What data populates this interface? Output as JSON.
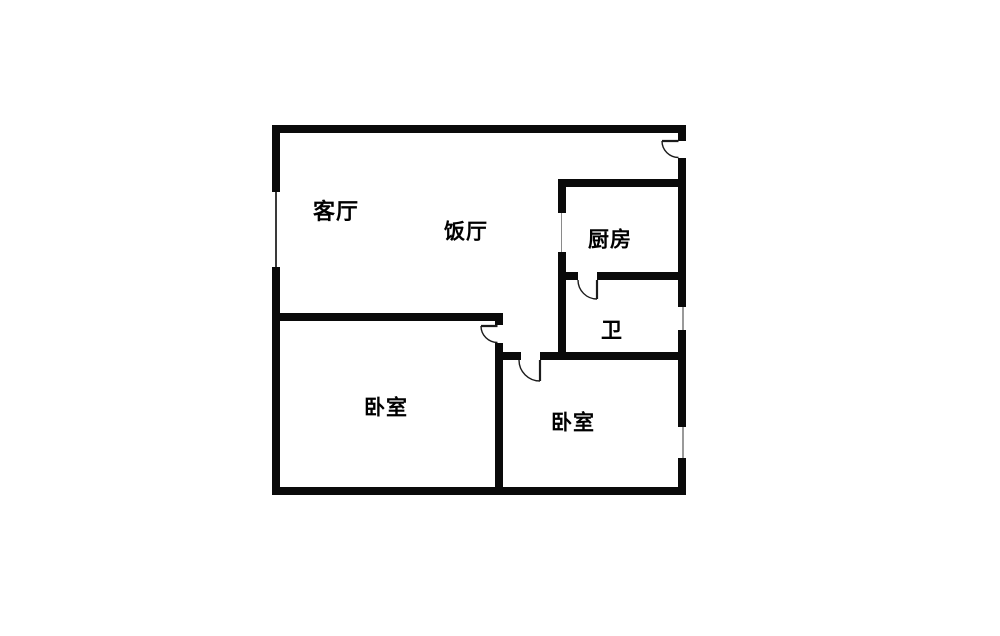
{
  "title": "two-bedroom-apartment-floor-plan",
  "colors": {
    "background": "#ffffff",
    "wall": "#0a0a0a",
    "door_line": "#1c1c1c",
    "window_line_dark": "#3a3a3a",
    "window_line_light": "#9a9a9a",
    "opening_line": "#8a8a8a",
    "label": "#000000"
  },
  "rooms": {
    "living_room": {
      "label": "客厅"
    },
    "dining_room": {
      "label": "饭厅"
    },
    "kitchen": {
      "label": "厨房"
    },
    "bathroom": {
      "label": "卫"
    },
    "bedroom_left": {
      "label": "卧室"
    },
    "bedroom_right": {
      "label": "卧室"
    }
  },
  "features": {
    "doors": [
      "entry-door",
      "bathroom-door",
      "bedroom-left-door",
      "bedroom-right-door"
    ],
    "windows": [
      "living-room-window-left-wall",
      "bathroom-window-right-wall",
      "bedroom-right-window-right-wall"
    ],
    "openings": [
      "kitchen-opening"
    ]
  }
}
